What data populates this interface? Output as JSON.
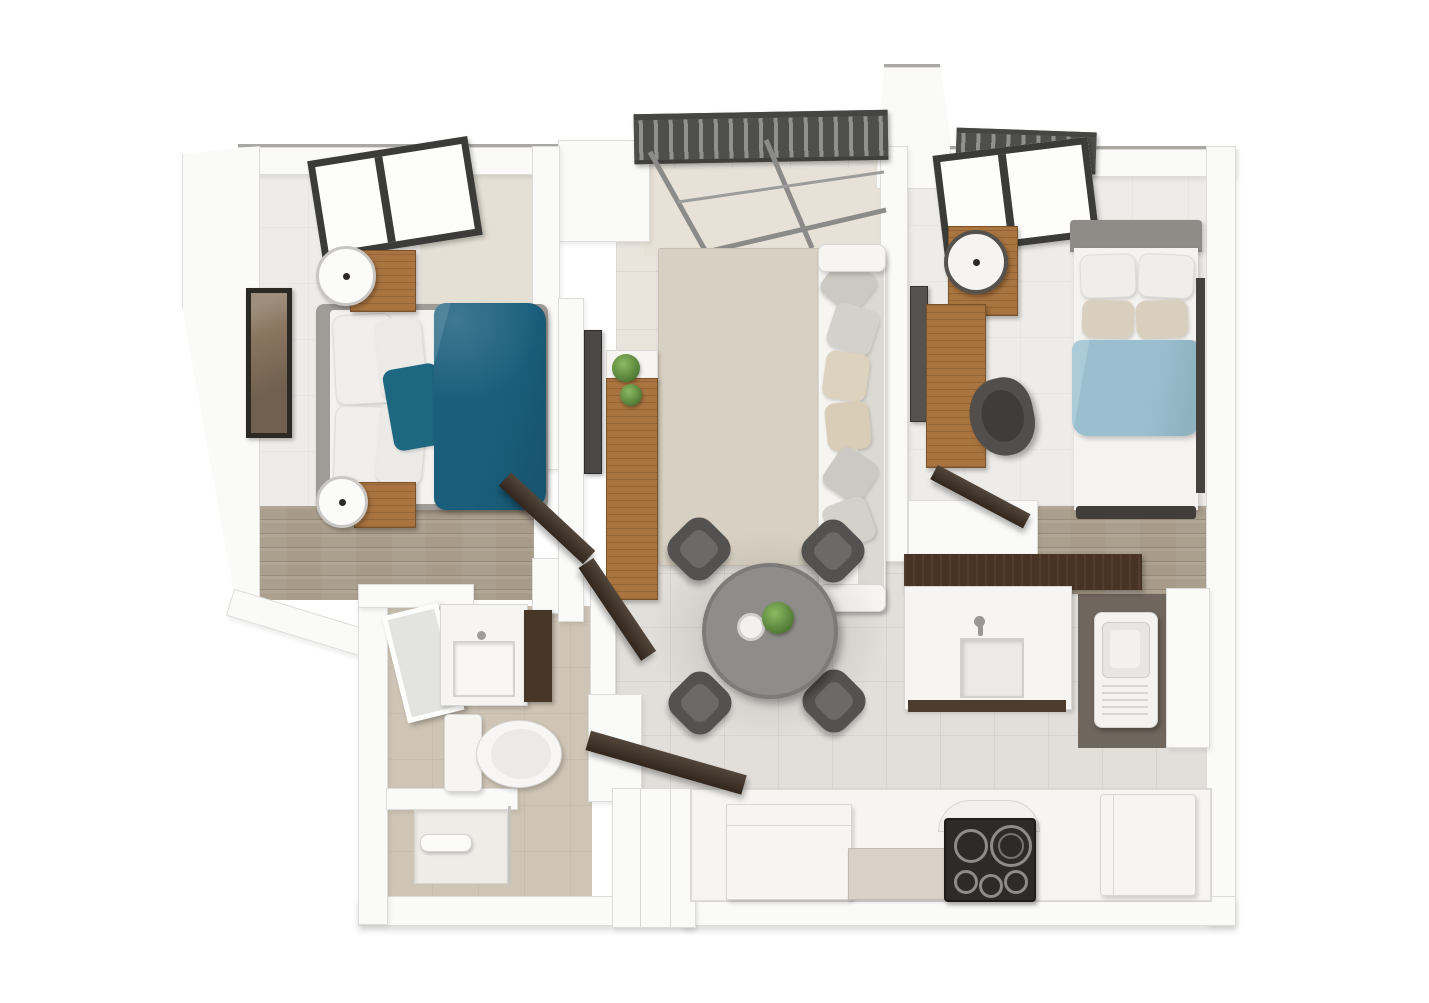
{
  "scene": {
    "label": "Two-bedroom apartment 3D floor plan, top-down render",
    "type": "3d-floor-plan-render",
    "view": "top-down",
    "visible_text": "none",
    "rooms": [
      {
        "name": "Bedroom 1",
        "furniture": [
          "double bed with teal duvet and teal accent pillow",
          "gray upholstered bed frame",
          "white pillows",
          "nightstand with round lamp (top)",
          "nightstand with round lamp (foot)",
          "framed wall art",
          "skylight window",
          "wood floor strip"
        ]
      },
      {
        "name": "Living Room",
        "furniture": [
          "light gray sofa with throw pillows",
          "beige area rug",
          "wall-mounted tv",
          "wood media console with plants",
          "louvered pergola over glass wall",
          "open balcony glazing"
        ]
      },
      {
        "name": "Dining Area",
        "furniture": [
          "round gray dining table",
          "four dark dining chairs",
          "table plant",
          "white cup"
        ]
      },
      {
        "name": "Bedroom 2",
        "furniture": [
          "double bed with light blue duvet",
          "gray headboard",
          "white and tan pillows",
          "nightstand with round lamp",
          "wood desk",
          "dark office chair",
          "wall-mounted tv",
          "window",
          "wood floor strip"
        ]
      },
      {
        "name": "Kitchen",
        "furniture": [
          "white sink counter with faucet",
          "dark walnut breakfast bar",
          "black glass cooktop with five burners",
          "white range hood arch",
          "built-in oven unit",
          "beige base cabinet",
          "refrigerator",
          "washing machine nook"
        ]
      },
      {
        "name": "Bathroom",
        "furniture": [
          "white vanity with basin",
          "tilted mirror",
          "dark side cabinet",
          "toilet",
          "shower tray with fixture",
          "glass partition"
        ]
      },
      {
        "name": "Hallway",
        "furniture": [
          "four dark open door leaves",
          "tile flooring"
        ]
      }
    ],
    "palette": {
      "background": "#ffffff",
      "wall": "#fafaf8",
      "wall_edge": "#dedcd8",
      "teal_duvet": "#1a5e7c",
      "teal_pillow": "#1d6781",
      "blue_duvet": "#9ac0cf",
      "wood_furniture": "#a9743f",
      "dark_walnut": "#483325",
      "door_dark": "#3b2d21",
      "sofa_white": "#f6f5f2",
      "pillow_gray": "#ccc8c2",
      "pillow_tan": "#ddd2bd",
      "rug_beige": "#d8d1c3",
      "tile_beige": "#e9e4dc",
      "tile_gray": "#e2dfda",
      "bathroom_floor": "#cfc5b6",
      "wood_floor": "#a89b8a",
      "table_gray": "#8f8d8a",
      "chair_dark": "#545250",
      "window_frame": "#3b3b39",
      "pergola_slats": "#4e4e4c",
      "cooktop_black": "#2d2b29",
      "headboard_gray": "#8f8c88"
    }
  }
}
